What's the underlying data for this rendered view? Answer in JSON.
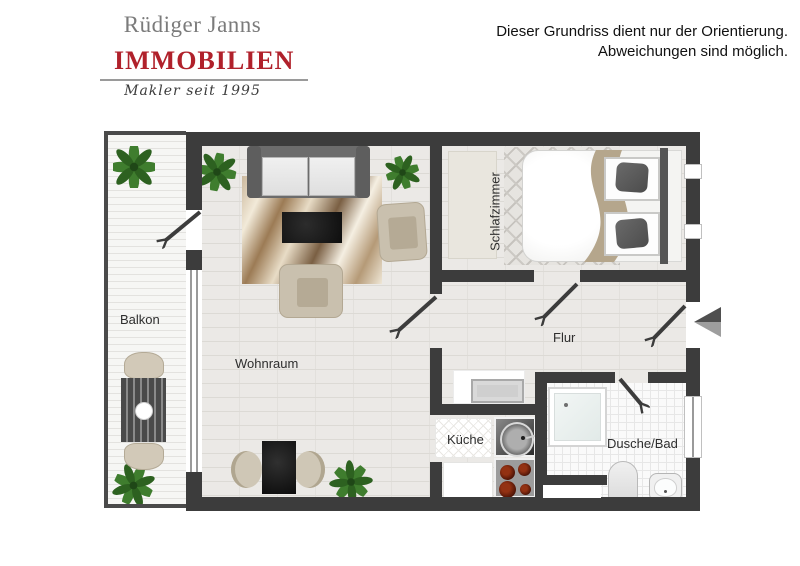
{
  "header": {
    "logo": {
      "name": "Rüdiger Janns",
      "main": "IMMOBILIEN",
      "tagline": "Makler seit 1995"
    },
    "disclaimer": {
      "line1": "Dieser Grundriss dient nur der Orientierung.",
      "line2": "Abweichungen sind möglich."
    }
  },
  "rooms": {
    "balkon": "Balkon",
    "wohnraum": "Wohnraum",
    "schlafzimmer": "Schlafzimmer",
    "flur": "Flur",
    "kueche": "Küche",
    "bad": "Dusche/Bad"
  },
  "icons": {
    "plant": "potted-plant",
    "entrance_arrow": "entrance-direction-arrow",
    "door_swing": "door-swing-arrow"
  },
  "colors": {
    "brand_red": "#b0212b",
    "logo_gray": "#7b7b7b",
    "wall_dark": "#3c3c3c",
    "floor_light": "#ebe9e6",
    "plant_green": "#3f7d2e",
    "beige_furniture": "#c9c0ae"
  }
}
